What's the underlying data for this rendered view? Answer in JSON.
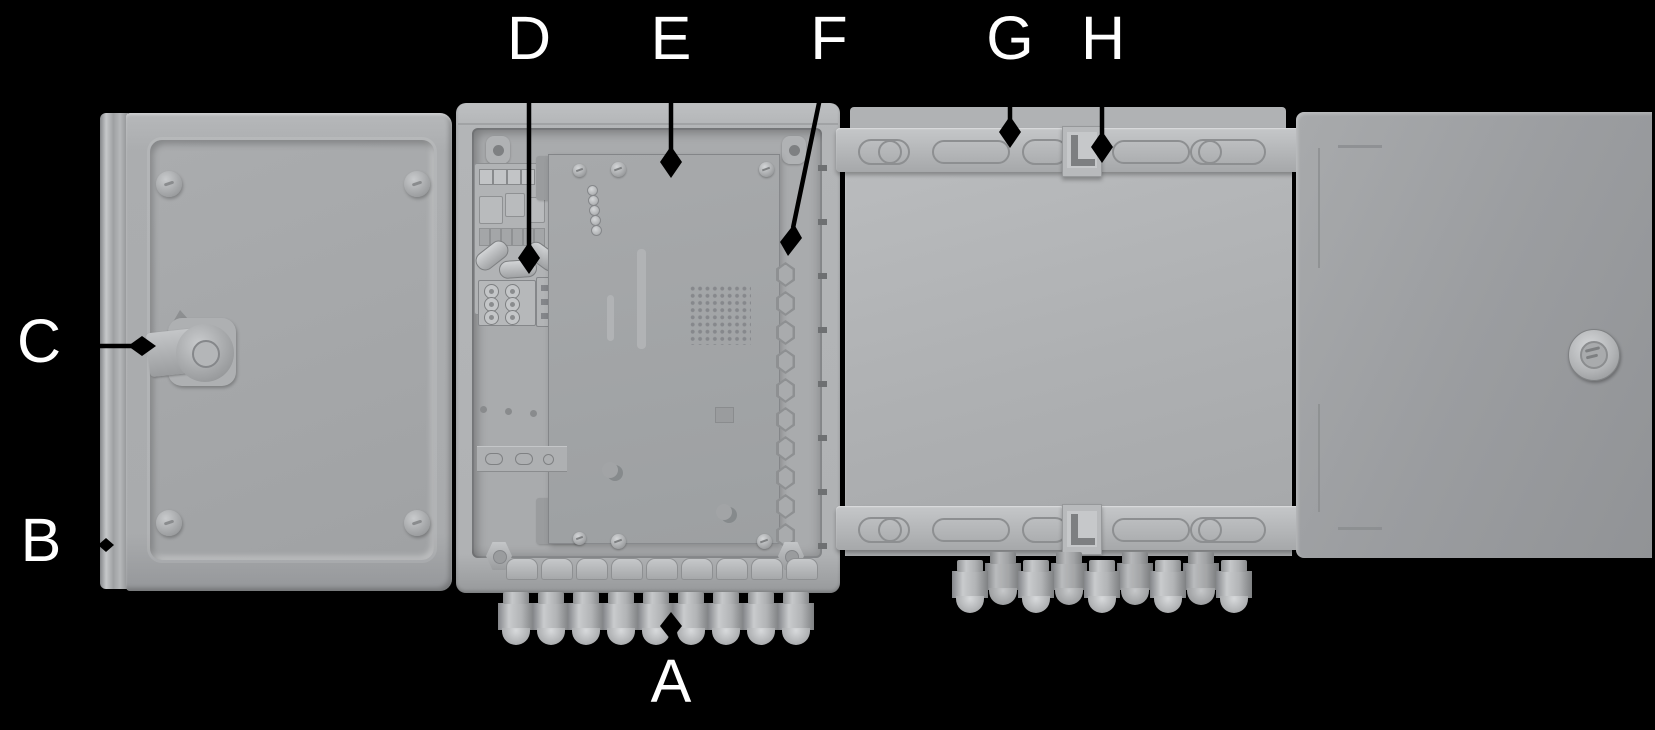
{
  "figure": {
    "kind": "enclosure-callout-diagram",
    "background_color": "#000000",
    "enclosure_color": "#b0b2b4",
    "door_exterior_color": "#9b9da0",
    "label_color": "#ffffff",
    "leader_color": "#000000"
  },
  "callouts": {
    "a": "A",
    "b": "B",
    "c": "C",
    "d": "D",
    "e": "E",
    "f": "F",
    "g": "G",
    "h": "H"
  }
}
